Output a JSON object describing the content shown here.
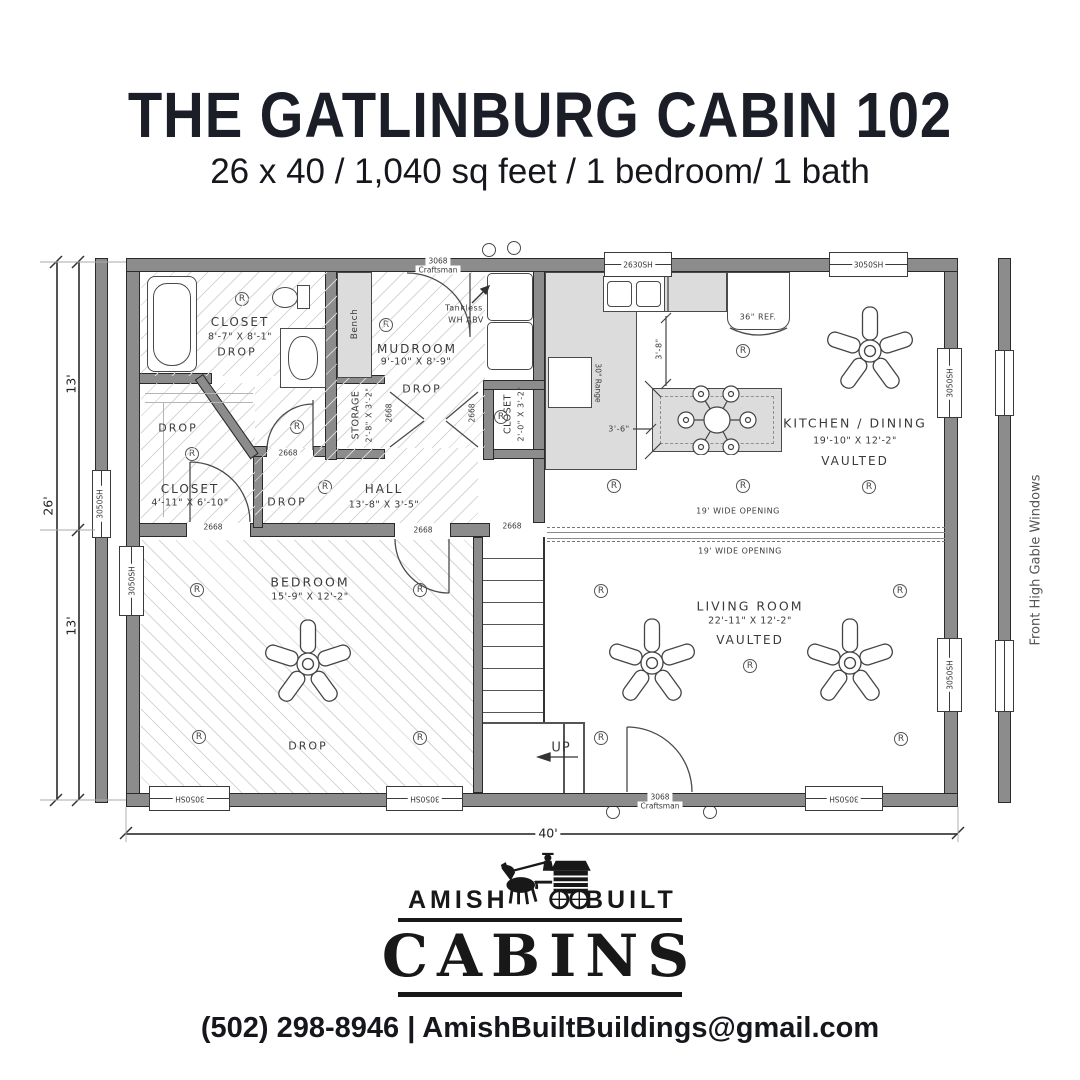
{
  "header": {
    "title": "THE GATLINBURG CABIN 102",
    "subtitle": "26 x 40 / 1,040 sq feet / 1 bedroom/ 1 bath"
  },
  "plan": {
    "rooms": {
      "bath": {
        "name": "CLOSET",
        "dims": "8'-7\" X 8'-1\"",
        "note": "DROP"
      },
      "mudroom": {
        "name": "MUDROOM",
        "dims": "9'-10\" X 8'-9\"",
        "note": "DROP"
      },
      "storage": {
        "name": "STORAGE",
        "dims": "2'-8\" X 3'-2\""
      },
      "closet_small": {
        "name": "CLOSET",
        "dims": "2'-0\" X 3'-2\""
      },
      "closet": {
        "name": "CLOSET",
        "dims": "4'-11\" X 6'-10\"",
        "note": "DROP"
      },
      "hall": {
        "name": "HALL",
        "dims": "13'-8\" X 3'-5\"",
        "note": "DROP"
      },
      "kitchen": {
        "name": "KITCHEN / DINING",
        "dims": "19'-10\" X 12'-2\"",
        "note": "VAULTED"
      },
      "living": {
        "name": "LIVING ROOM",
        "dims": "22'-11\" X 12'-2\"",
        "note": "VAULTED"
      },
      "bedroom": {
        "name": "BEDROOM",
        "dims": "15'-9\" X 12'-2\"",
        "note": "DROP"
      }
    },
    "labels": {
      "bench": "Bench",
      "tankless_1": "Tankless",
      "tankless_2": "WH ABV",
      "range": "30\" Range",
      "ref": "36\" REF.",
      "up": "UP",
      "opening": "19' WIDE OPENING",
      "gable": "Front High Gable Windows",
      "door_big": "3068",
      "door_big_style": "Craftsman",
      "door_small": "2668",
      "win_kitchen": "2630SH",
      "win_std": "3050SH",
      "recessed": "R"
    },
    "dims": {
      "total_width": "40'",
      "total_depth": "26'",
      "half_depth_top": "13'",
      "half_depth_bottom": "13'",
      "counter_clear": "3'-8\"",
      "island_clear": "3'-6\""
    }
  },
  "footer": {
    "logo": {
      "left": "AMISH",
      "right": "BUILT",
      "main": "CABINS"
    },
    "contact": "(502) 298-8946 | AmishBuiltBuildings@gmail.com"
  }
}
